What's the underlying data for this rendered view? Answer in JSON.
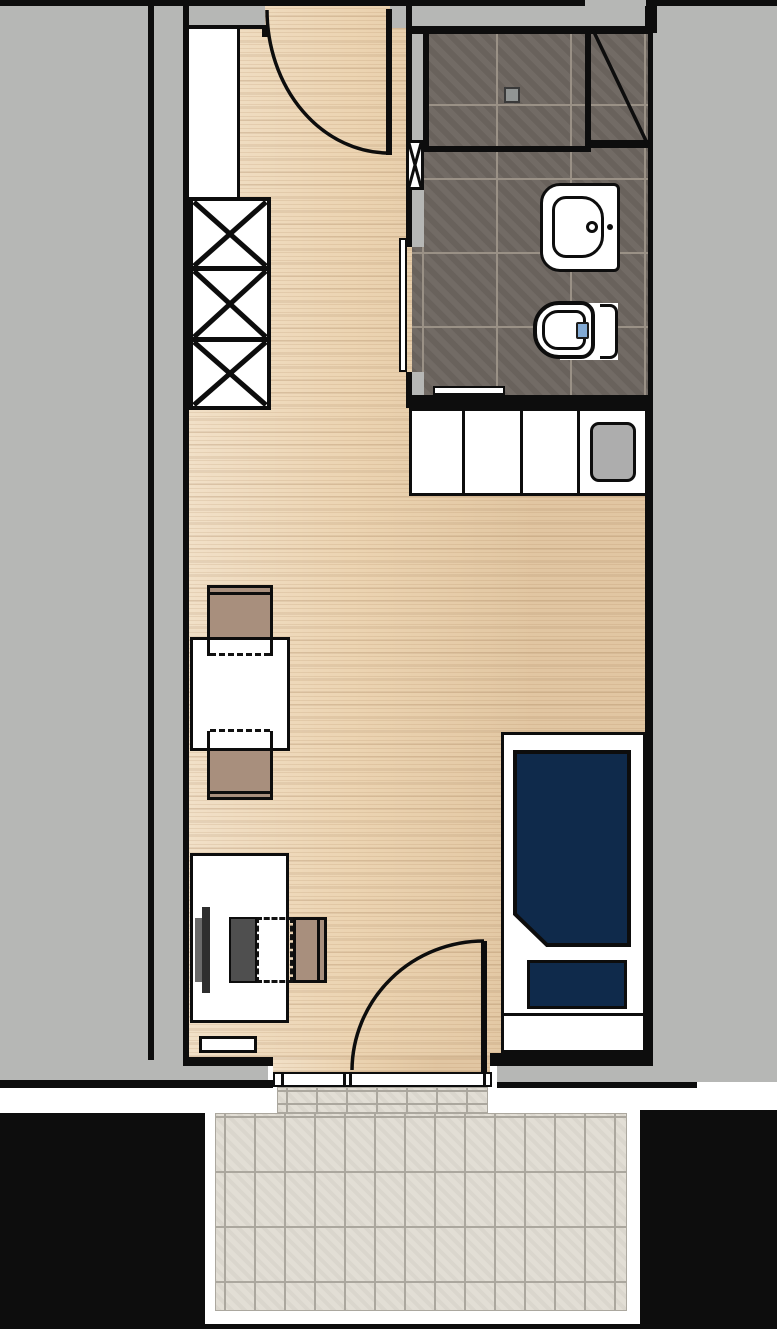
{
  "meta": {
    "type": "architectural-floor-plan",
    "description": "studio apartment plan with bathroom, kitchenette, living area and balcony",
    "visible_text": "none",
    "labels_shown": false
  },
  "palette": {
    "wall_black": "#0d0d0d",
    "exterior_gray": "#b6b7b5",
    "wood_floor": "#ecd4b2",
    "bathroom_tile": "#6d6660",
    "bathroom_grout": "#9a9186",
    "balcony_tile": "#e0dcd3",
    "balcony_grout": "#aba79e",
    "mattress_navy": "#0f2a4b",
    "chair_tan": "#a88f7d",
    "fixture_white": "#ffffff",
    "kitchen_sink_gray": "#adadad",
    "desk_equipment_gray": "#4f4f4f",
    "flush_button_blue": "#82aad4",
    "outside_fill": "#000000"
  },
  "rooms": {
    "living_area": {
      "floor": "wood",
      "furniture": [
        "wardrobe",
        "dining-table",
        "dining-chair-top",
        "dining-chair-bottom",
        "desk",
        "desk-chair",
        "monitor",
        "bed"
      ]
    },
    "bathroom": {
      "floor": "dark-tile",
      "fixtures": [
        "shower",
        "shower-glass-door",
        "floor-drain",
        "washbasin",
        "faucet",
        "toilet",
        "towel-rail",
        "sliding-door",
        "installation-shaft"
      ]
    },
    "kitchenette": {
      "cabinet_sections": 4,
      "fixtures": [
        "kitchen-sink"
      ]
    },
    "balcony": {
      "floor": "light-tile",
      "access": "hinged-door",
      "tile_rows": 4
    }
  },
  "wardrobe": {
    "sections": 3,
    "symbol": "x-crossed-boxes"
  },
  "bed": {
    "mattress": "navy",
    "pillow": "navy",
    "corner": "beveled-bottom-left"
  },
  "doors": {
    "entry": {
      "type": "swing",
      "hinge": "top-right",
      "location": "top-wall"
    },
    "bathroom": {
      "type": "sliding",
      "location": "left-bathroom-wall"
    },
    "balcony": {
      "type": "swing",
      "hinge": "bottom-right",
      "location": "bottom-wall"
    }
  }
}
